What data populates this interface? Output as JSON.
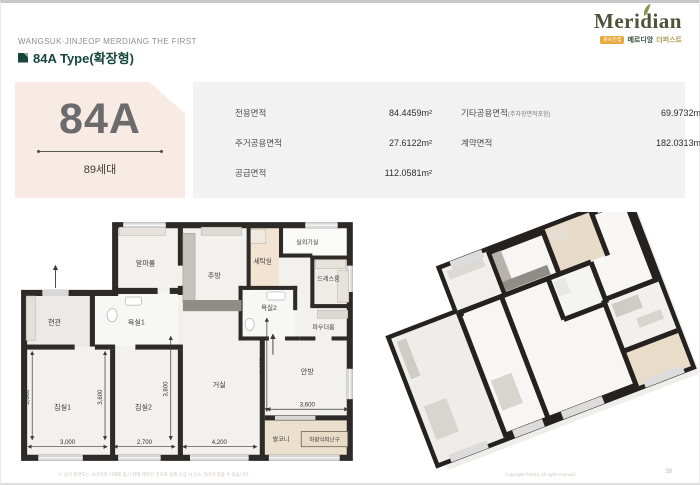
{
  "header": {
    "project_name": "WANGSUK·JINJEOP MERDIANG THE FIRST",
    "title": "84A Type(확장형)"
  },
  "logo": {
    "brand": "Meridian",
    "badge": "왕숙진접",
    "sub1": "메르디앙",
    "sub2": "더퍼스트"
  },
  "unit": {
    "name": "84A",
    "households": "89세대"
  },
  "area_table": {
    "rows_left": [
      {
        "label": "전용면적",
        "value": "84.4459m²"
      },
      {
        "label": "주거공용면적",
        "value": "27.6122m²"
      },
      {
        "label": "공급면적",
        "value": "112.0581m²"
      }
    ],
    "rows_right": [
      {
        "label": "기타공용면적",
        "label_sub": "(주차장면적포함)",
        "value": "69.9732m²"
      },
      {
        "label": "계약면적",
        "label_sub": "",
        "value": "182.0313m²"
      }
    ]
  },
  "floorplan": {
    "rooms": {
      "entrance": "현관",
      "bath1": "욕실1",
      "alpha": "알파룸",
      "kitchen": "주방",
      "laundry": "세탁실",
      "outdoor_unit": "실외기실",
      "dress": "드레스룸",
      "bath2": "욕실2",
      "powder": "파우더룸",
      "bed1": "침실1",
      "bed2": "침실2",
      "living": "거실",
      "master": "안방",
      "balcony": "발코니",
      "escape_hatch": "하향식피난구"
    },
    "dims": {
      "bed1_w": "3,000",
      "bed1_h": "3,600",
      "bed2_w": "2,700",
      "bed2_h": "3,600",
      "living_w": "4,200",
      "living_h": "3,800",
      "master_w": "3,600",
      "master_h": "3,995"
    }
  },
  "footer": {
    "disclaimer": "※ 상기 평면도는 소비자의 이해를 돕기 위해 제작된 것으로 실제 시공 시 다소 차이가 있을 수 있습니다.",
    "copyright": "Copyright ©2023. All right reserved.",
    "page_number": "38"
  },
  "colors": {
    "brand_green": "#17473a",
    "logo_olive": "#4d5238",
    "badge_orange": "#e9a63a",
    "panel_peach": "#f8ebe3",
    "panel_gray": "#f1f2f1",
    "wall_dark": "#2d2a27",
    "balcony_beige": "#ebdfcd"
  }
}
